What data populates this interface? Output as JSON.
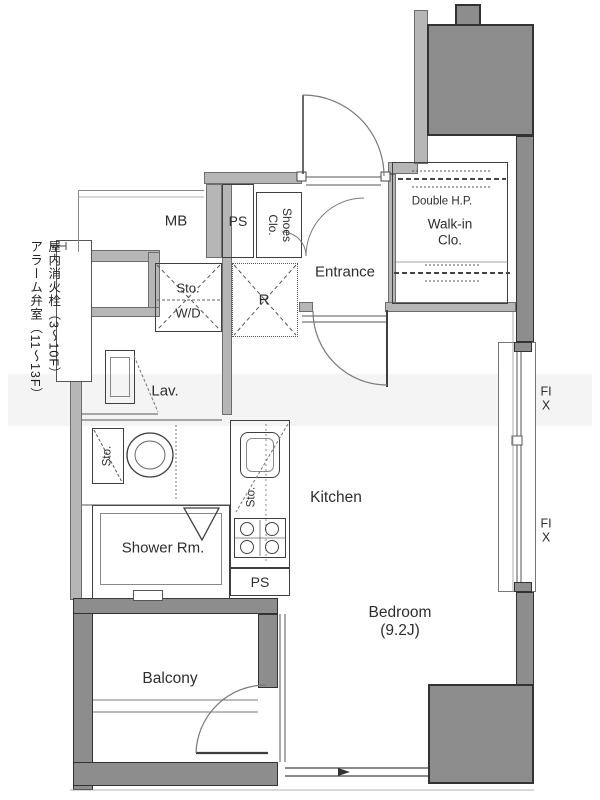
{
  "plan": {
    "rooms": {
      "mb": "MB",
      "ps_top": "PS",
      "shoes_closet": "Shoes Clo.",
      "entrance": "Entrance",
      "double_hp": "Double H.P.",
      "walk_in_closet": "Walk-in Clo.",
      "storage_top": "Sto.",
      "washer_dryer": "W/D",
      "refrigerator": "R",
      "lavatory": "Lav.",
      "storage_toilet": "Sto.",
      "storage_kitchen": "Sto.",
      "kitchen": "Kitchen",
      "shower_room": "Shower Rm.",
      "ps_bottom": "PS",
      "balcony": "Balcony",
      "bedroom": "Bedroom",
      "bedroom_size": "(9.2J)"
    },
    "windows": {
      "fix_upper": "FIX",
      "fix_lower": "FIX"
    },
    "notes": {
      "fire_hydrant": "屋内消火栓（3〜10F）\nアラーム弁室（11〜13F）"
    },
    "colors": {
      "wall_light": "#b6b6b6",
      "wall_dark": "#8d8d8d",
      "line": "#3f3f3f"
    }
  }
}
